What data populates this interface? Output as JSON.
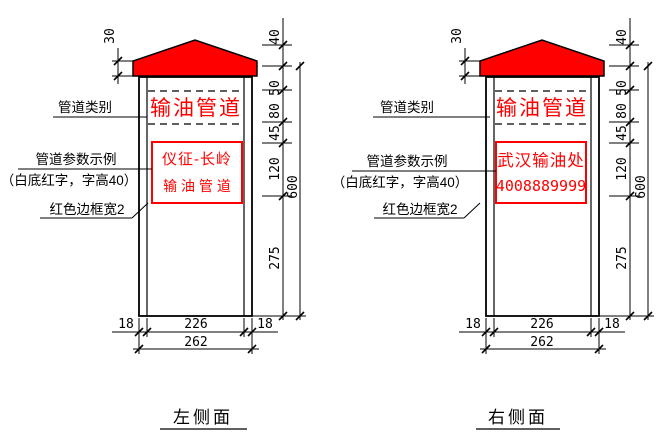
{
  "colors": {
    "accent_red": "#ff0000",
    "line_black": "#000000"
  },
  "left": {
    "title": "左侧面",
    "header": "输油管道",
    "sign_line1": "仪征-长岭",
    "sign_line2": "输 油 管 道",
    "labels": {
      "category": "管道类别",
      "params": "管道参数示例",
      "params_note": "（白底红字，字高40）",
      "border_width": "红色边框宽2"
    },
    "dims": {
      "band_height": "30",
      "roof_height": "40",
      "seg_50": "50",
      "seg_80": "80",
      "seg_45": "45",
      "seg_120": "120",
      "lower_height": "275",
      "total_height": "600",
      "side_left": "18",
      "inner_width": "226",
      "side_right": "18",
      "total_width": "262"
    }
  },
  "right": {
    "title": "右侧面",
    "header": "输油管道",
    "sign_line1": "武汉输油处",
    "sign_line2": "4008889999",
    "labels": {
      "category": "管道类别",
      "params": "管道参数示例",
      "params_note": "（白底红字，字高40）",
      "border_width": "红色边框宽2"
    },
    "dims": {
      "band_height": "30",
      "roof_height": "40",
      "seg_50": "50",
      "seg_80": "80",
      "seg_45": "45",
      "seg_120": "120",
      "lower_height": "275",
      "total_height": "600",
      "side_left": "18",
      "inner_width": "226",
      "side_right": "18",
      "total_width": "262"
    }
  }
}
